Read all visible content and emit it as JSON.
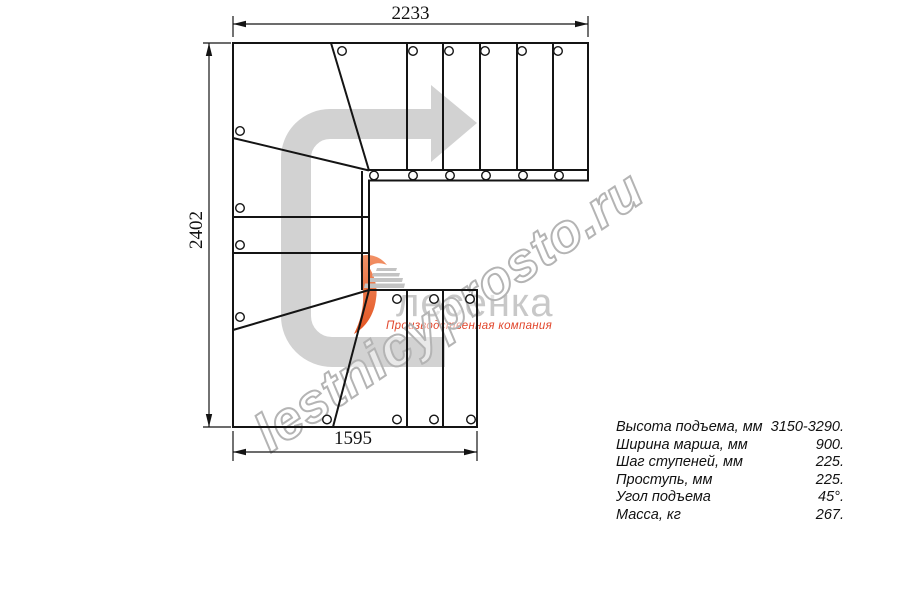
{
  "dimensions": {
    "top": "2233",
    "left": "2402",
    "bottom": "1595"
  },
  "specs": {
    "rows": [
      {
        "label": "Высота подъема, мм",
        "value": "3150-3290."
      },
      {
        "label": "Ширина марша, мм",
        "value": "900."
      },
      {
        "label": "Шаг ступеней, мм",
        "value": "225."
      },
      {
        "label": "Проступь, мм",
        "value": "225."
      },
      {
        "label": "Угол подъема",
        "value": "45°."
      },
      {
        "label": "Масса, кг",
        "value": "267."
      }
    ]
  },
  "logo": {
    "brand": "лесенка",
    "tagline": "Производственная компания"
  },
  "watermark": {
    "text": "lestnicyprosto.ru"
  },
  "icons": {
    "direction_arrow": "curved-up-right-arrow",
    "logo_icon": "stairs-swoosh"
  },
  "colors": {
    "line": "#141414",
    "arrow_gray": "#d2d2d2",
    "brand_gray": "#c8c8c8",
    "watermark_gray": "#b4b4b4",
    "accent_orange": "#e8512b"
  }
}
